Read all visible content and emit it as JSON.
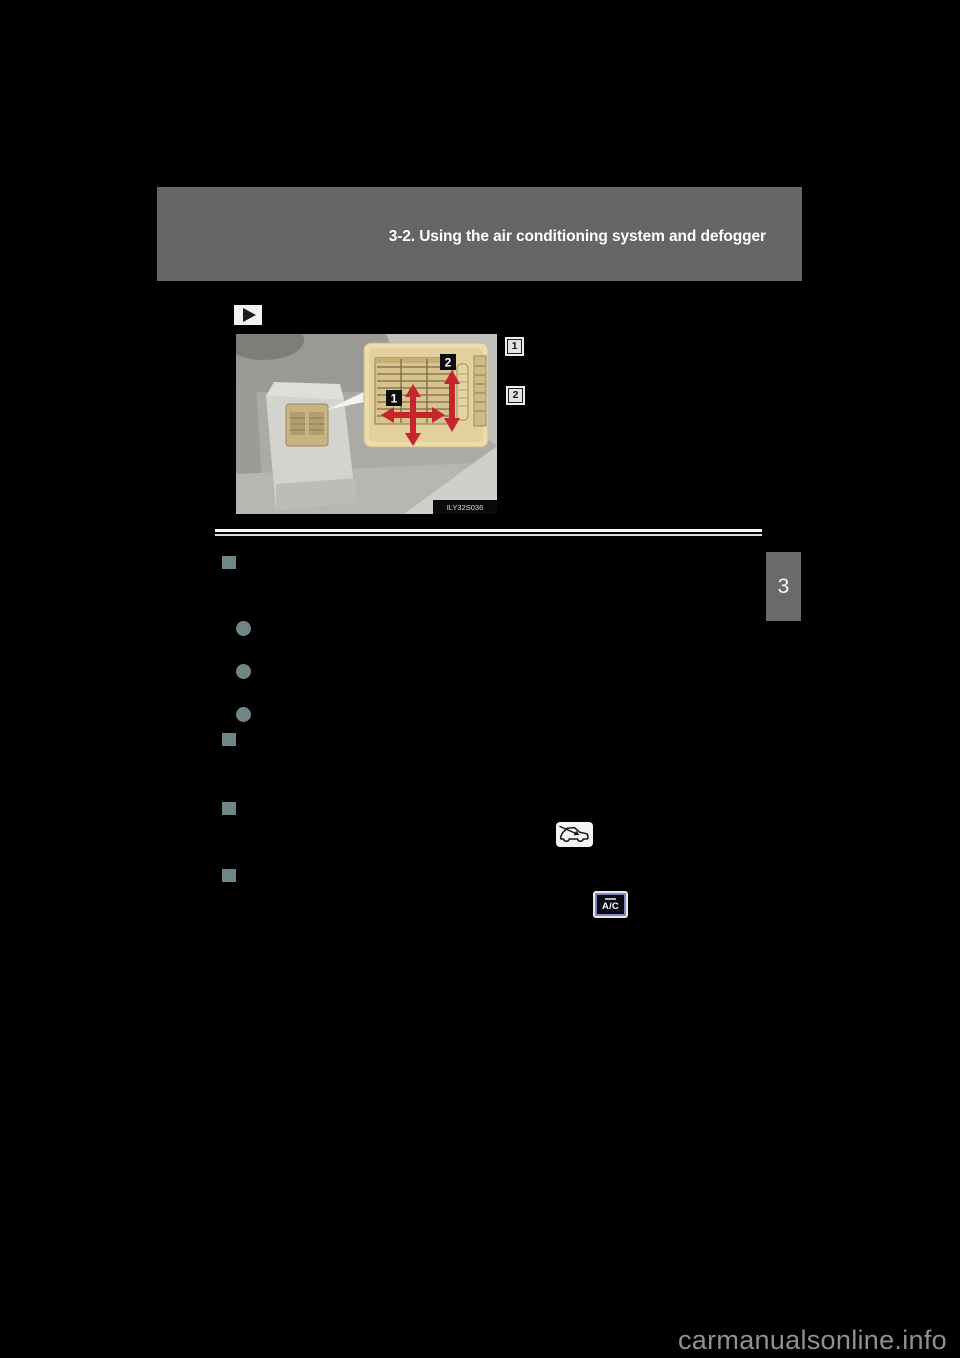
{
  "page": {
    "background_color": "#000000"
  },
  "header": {
    "title": "3-2. Using the air conditioning system and defogger",
    "background_color": "#656565",
    "text_color": "#ffffff"
  },
  "figure": {
    "pointer_icon": "play-arrow",
    "image_code": "ILY32S036",
    "inset_markers": {
      "vent_direction": "1",
      "airflow_dial": "2"
    },
    "side_markers": {
      "first": "1",
      "second": "2"
    },
    "arrow_color": "#c4262c"
  },
  "content": {
    "bullet_color": "#6d8686",
    "bullets": [
      {
        "shape": "square"
      },
      {
        "shape": "circle"
      },
      {
        "shape": "circle"
      },
      {
        "shape": "circle"
      },
      {
        "shape": "square"
      },
      {
        "shape": "square"
      },
      {
        "shape": "square"
      }
    ],
    "fresh_air_icon": "car-outside-air-intake",
    "ac_button_label": "A/C"
  },
  "section_tab": {
    "number": "3",
    "background_color": "#6a6a6a"
  },
  "watermark": {
    "text": "carmanualsonline.info",
    "color": "#909090"
  }
}
